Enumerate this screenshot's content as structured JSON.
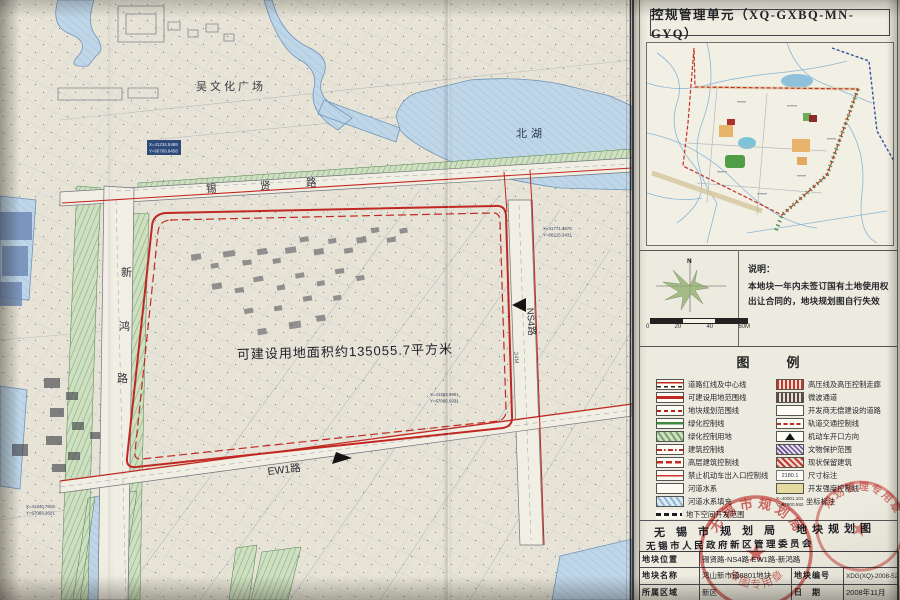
{
  "map": {
    "area_label": "可建设用地面积约135055.7平方米",
    "plaza_label": "吴文化广场",
    "lake_label": "北湖",
    "road_xixian": [
      "锡",
      "贤",
      "路"
    ],
    "road_xinhong": [
      "新",
      "鸿",
      "路"
    ],
    "road_ns4": "NS4路",
    "road_ns4_width": "24M",
    "road_ew1": "EW1路",
    "coords": [
      {
        "x": "X=41234.5489",
        "y": "Y=66789.8458"
      },
      {
        "x": "X=41771.3678",
        "y": "Y=66215.3431"
      },
      {
        "x": "X=41263.9901",
        "y": "Y=67095.0931"
      },
      {
        "x": "X=41340.7815",
        "y": "Y=67083.2621"
      }
    ]
  },
  "panel": {
    "title": "控规管理单元（XQ-GXBQ-MN-GYQ）",
    "north_label": "N",
    "scalebar_labels": [
      "0",
      "20",
      "40",
      "60M"
    ],
    "note_title": "说明：",
    "note_line1": "本地块一年内未签订国有土地使用权",
    "note_line2": "出让合同的，地块规划图自行失效",
    "legend_title": "图　例",
    "legend": {
      "left": [
        "道路红线及中心线",
        "可建设用地范围线",
        "地块规划范围线",
        "绿化控制线",
        "绿化控制用地",
        "建筑控制线",
        "高层建筑控制线",
        "禁止机动车出入口控制线",
        "河道水系",
        "河道水系填充",
        "地下空间开发范围"
      ],
      "right": [
        "高压线及高压控制走廊",
        "微波通道",
        "开发商无偿建设的道路",
        "轨道交通控制线",
        "机动车开口方向",
        "文物保护范围",
        "现状保留建筑",
        "尺寸标注",
        "开发强度控制线",
        "坐标标注"
      ],
      "dim_sample": "2180.1",
      "coord_sample_x": "X=40001.101",
      "coord_sample_y": "Y=67900.582"
    },
    "signature_org": "无锡市规划局",
    "signature_doc": "地块规划图",
    "signature_org2": "无锡市人民政府新区管理委员会",
    "table": {
      "r1_label": "地块位置",
      "r1_value": "锡贤路-NS4路-EW1路-新鸿路",
      "r2_label": "地块名称",
      "r2_value": "鸿山新市镇8801地块",
      "r2_label2": "地块编号",
      "r2_value2": "XDG(XQ)-2008-52号",
      "r3_label": "所属区域",
      "r3_value": "新区",
      "r3_label2": "日　期",
      "r3_value2": "2008年11月"
    },
    "stamp1_top": "无锡市规划局",
    "stamp1_bottom": "审图专用章",
    "stamp2_top": "规划管理专用章",
    "stamp_star": "★"
  }
}
